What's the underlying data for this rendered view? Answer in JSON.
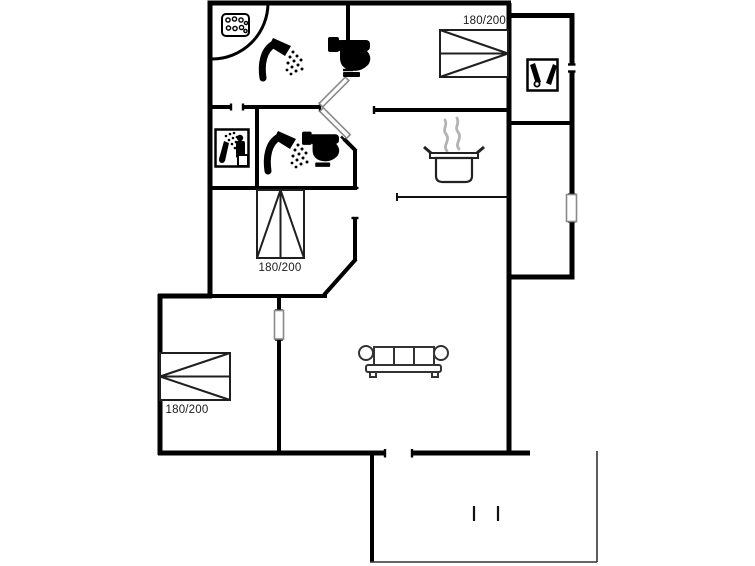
{
  "floorplan": {
    "bed_labels": [
      {
        "room": "bedroom-top-right",
        "label": "180/200"
      },
      {
        "room": "bedroom-middle",
        "label": "180/200"
      },
      {
        "room": "bedroom-bottom-left",
        "label": "180/200"
      }
    ],
    "icons": [
      "whirlpool-icon",
      "corner-tub-arc",
      "shower-icon",
      "toilet-icon",
      "sauna-icon",
      "cleaning-equipment-icon",
      "cooking-pot-icon",
      "sofa-icon",
      "terrace-step-marks"
    ],
    "colors": {
      "walls": "#000000",
      "furniture_outline": "#333333",
      "steam": "#b3b3b3",
      "text": "#1a1a1a",
      "background": "#ffffff"
    }
  }
}
